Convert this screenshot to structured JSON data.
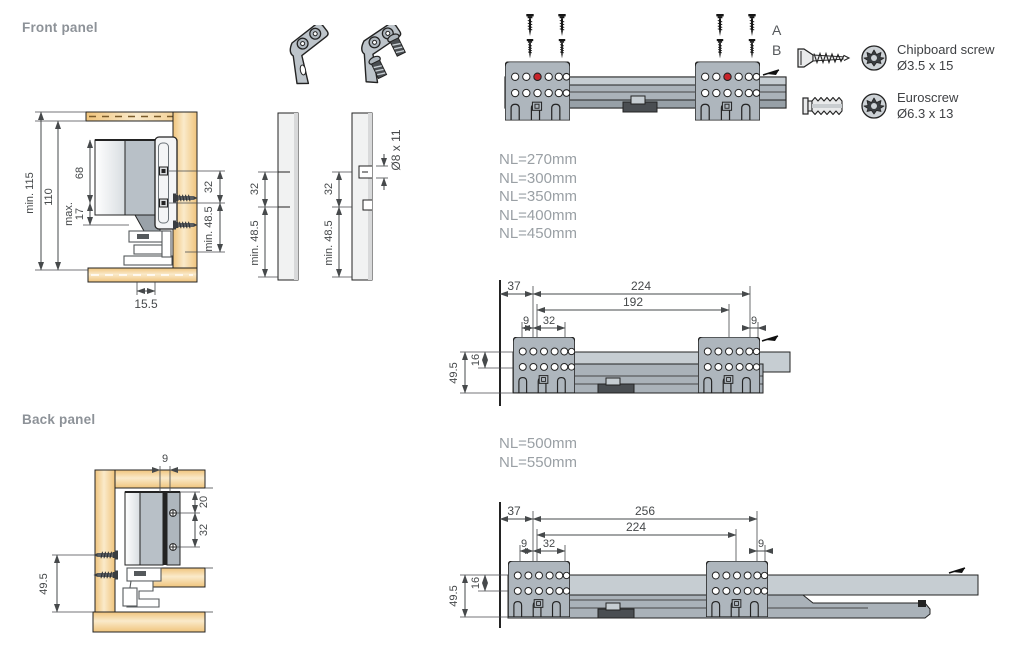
{
  "labels": {
    "front_panel": "Front panel",
    "back_panel": "Back panel"
  },
  "colors": {
    "wood_edge": "#f2c985",
    "wood_core": "#faeaca",
    "metal": "#aeb6bd",
    "metal_light": "#c6cdd2",
    "metal_dark": "#99a1a8",
    "red_hole": "#c8242b",
    "line": "#232323",
    "dim": "#46494b",
    "label_gray": "#8d9298",
    "nl_gray": "#9aa0a5"
  },
  "front_section": {
    "dims": {
      "min115": "min. 115",
      "d110": "110",
      "d68": "68",
      "max17_word": "max.",
      "max17_num": "17",
      "d32": "32",
      "min485": "min. 48.5",
      "d155": "15.5"
    }
  },
  "strips": {
    "strip1": {
      "d32": "32",
      "min485": "min. 48.5"
    },
    "strip2": {
      "d32": "32",
      "min485": "min. 48.5",
      "hole": "Ø8 x 11"
    }
  },
  "top_assembly": {
    "label_a": "A",
    "label_b": "B"
  },
  "screw_legend": {
    "items": [
      {
        "name": "Chipboard screw",
        "size": "Ø3.5 x 15"
      },
      {
        "name": "Euroscrew",
        "size": "Ø6.3 x 13"
      }
    ]
  },
  "nominal_lengths_short": {
    "items": [
      "NL=270mm",
      "NL=300mm",
      "NL=350mm",
      "NL=400mm",
      "NL=450mm"
    ]
  },
  "nominal_lengths_long": {
    "items": [
      "NL=500mm",
      "NL=550mm"
    ]
  },
  "mid_drawing": {
    "dims": {
      "d37": "37",
      "d224": "224",
      "d192": "192",
      "d9_left": "9",
      "d32": "32",
      "d9_right": "9",
      "d16": "16",
      "d495": "49.5"
    }
  },
  "bottom_drawing": {
    "dims": {
      "d37": "37",
      "d256": "256",
      "d224": "224",
      "d9_left": "9",
      "d32": "32",
      "d9_right": "9",
      "d16": "16",
      "d495": "49.5"
    }
  },
  "back_section": {
    "dims": {
      "d9": "9",
      "d20": "20",
      "d32": "32",
      "d495": "49.5"
    }
  }
}
